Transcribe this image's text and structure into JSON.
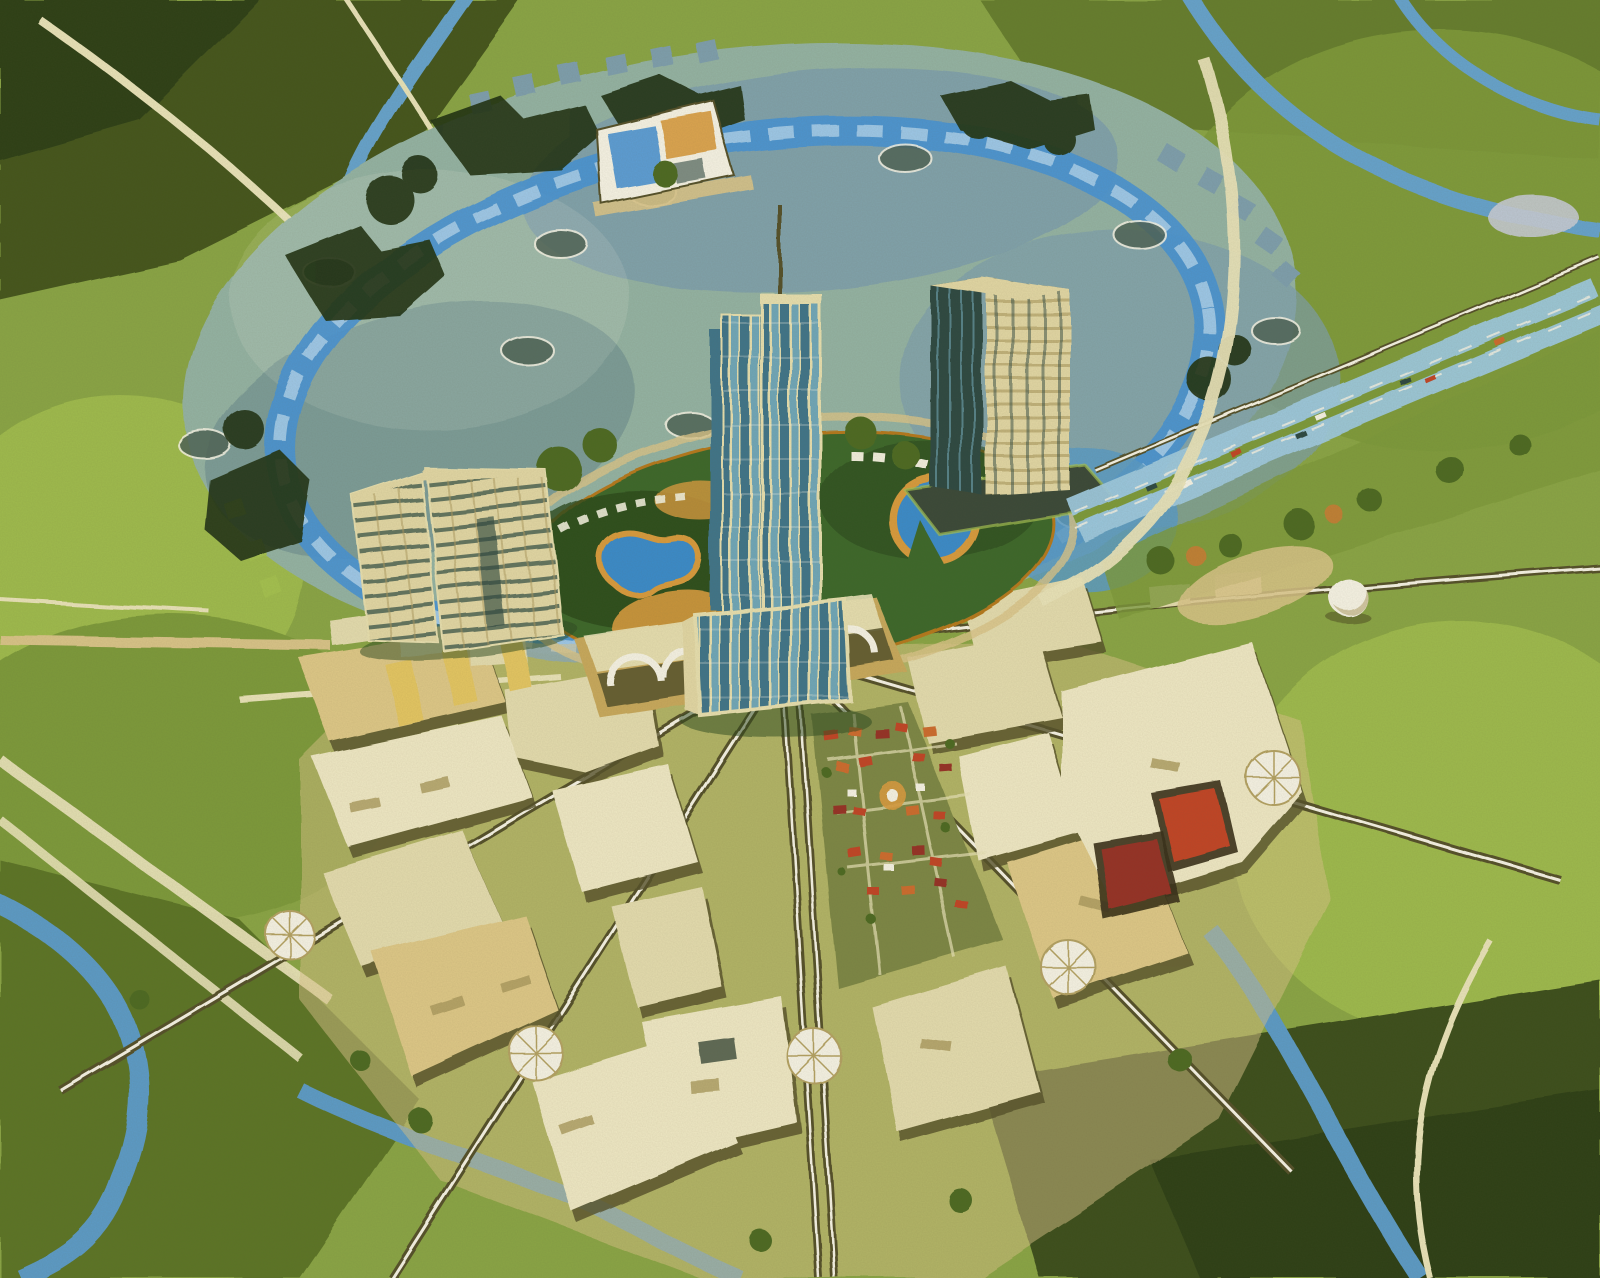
{
  "artwork": {
    "title": "Radial garden-city aerial concept painting",
    "medium": "gouache-style architectural illustration, bird's-eye view",
    "features": [
      {
        "name": "circular-plaza",
        "desc": "large teal paved plaza with oval skylight domes and gear-tooth edges"
      },
      {
        "name": "ring-road",
        "desc": "bright blue circular roadway around the urban core"
      },
      {
        "name": "central-tower",
        "desc": "tall blue-glass tower with rooftop spire at the city center"
      },
      {
        "name": "tower-podium",
        "desc": "curved glass screen podium at the tower base"
      },
      {
        "name": "office-slab-west",
        "desc": "angled mid-rise slab offices with banded floors"
      },
      {
        "name": "office-tower-east",
        "desc": "rectangular cream-grid office tower on a dark plinth"
      },
      {
        "name": "entry-pavilion",
        "desc": "small colorful pavilion at the north plaza edge"
      },
      {
        "name": "central-garden",
        "desc": "oval garden with kidney-shaped pools, orange decks and white sawtooth canopies"
      },
      {
        "name": "transit-hub",
        "desc": "arched monorail station south of the tower"
      },
      {
        "name": "radial-monorails",
        "desc": "monorail streets fanning outward from the hub"
      },
      {
        "name": "residential-fan",
        "desc": "radial wedges of cream flat-roof housing blocks"
      },
      {
        "name": "village-quarter",
        "desc": "red tile-roof old-town wedge with tiny houses"
      },
      {
        "name": "red-court-halls",
        "desc": "two red trapezoid halls sunk into the east wedge"
      },
      {
        "name": "plaza-nodes",
        "desc": "white ribbed circular pavilions at street crossings"
      },
      {
        "name": "highway",
        "desc": "multi-lane divided highway with cars on the east side"
      },
      {
        "name": "greenbelt",
        "desc": "rolling green fields, dark tree masses, blue roads and streams"
      }
    ]
  },
  "palette": {
    "canvas_base": "#8aa544",
    "grass_bright": "#a4c150",
    "grass_mid": "#7d9a3b",
    "grass_olive": "#5c7428",
    "grass_dark": "#3c4f1c",
    "tree_dark": "#243516",
    "tree_green": "#4d6b24",
    "tree_orange": "#c08035",
    "road_blue": "#66a3cc",
    "road_blue_pale": "#9ec9de",
    "path_cream": "#e9e3b8",
    "path_tan": "#d9c488",
    "plaza_teal": "#94b3a3",
    "plaza_blue": "#7e9fad",
    "plaza_shadow": "#64868b",
    "ring_blue": "#4a94d2",
    "ring_blue_light": "#a6cdea",
    "dome_dark": "#4f6457",
    "garden_green": "#3e682c",
    "garden_dark": "#2a481d",
    "pool_blue": "#3a8bc9",
    "deck_orange": "#d89b3e",
    "deck_orange_dark": "#b5791f",
    "sawtooth_white": "#f2efdd",
    "tower_glass": "#6fa7b8",
    "tower_glass_dark": "#3f7489",
    "tower_mullion": "#e7dfae",
    "facade_cream": "#e2d7a4",
    "facade_shadow": "#ab9a5e",
    "glass_dark": "#2f4a42",
    "plinth_dark": "#3a4a38",
    "roof_cream": "#efe8c4",
    "roof_pale": "#e4dcae",
    "roof_gold": "#dec887",
    "roof_shade": "#b4a263",
    "shadow_olive": "#55512a",
    "shadow_dark": "#39301a",
    "red_roof": "#c14527",
    "red_deep": "#963326",
    "orange_roof": "#cd6c2f",
    "white_glare": "#f6f3e4",
    "stream_blue": "#5b9bc6",
    "hub_tan": "#c8a95c",
    "village_base": "#7d8745",
    "yellow_block": "#e4c662",
    "pond_grey": "#c6cbd4"
  }
}
